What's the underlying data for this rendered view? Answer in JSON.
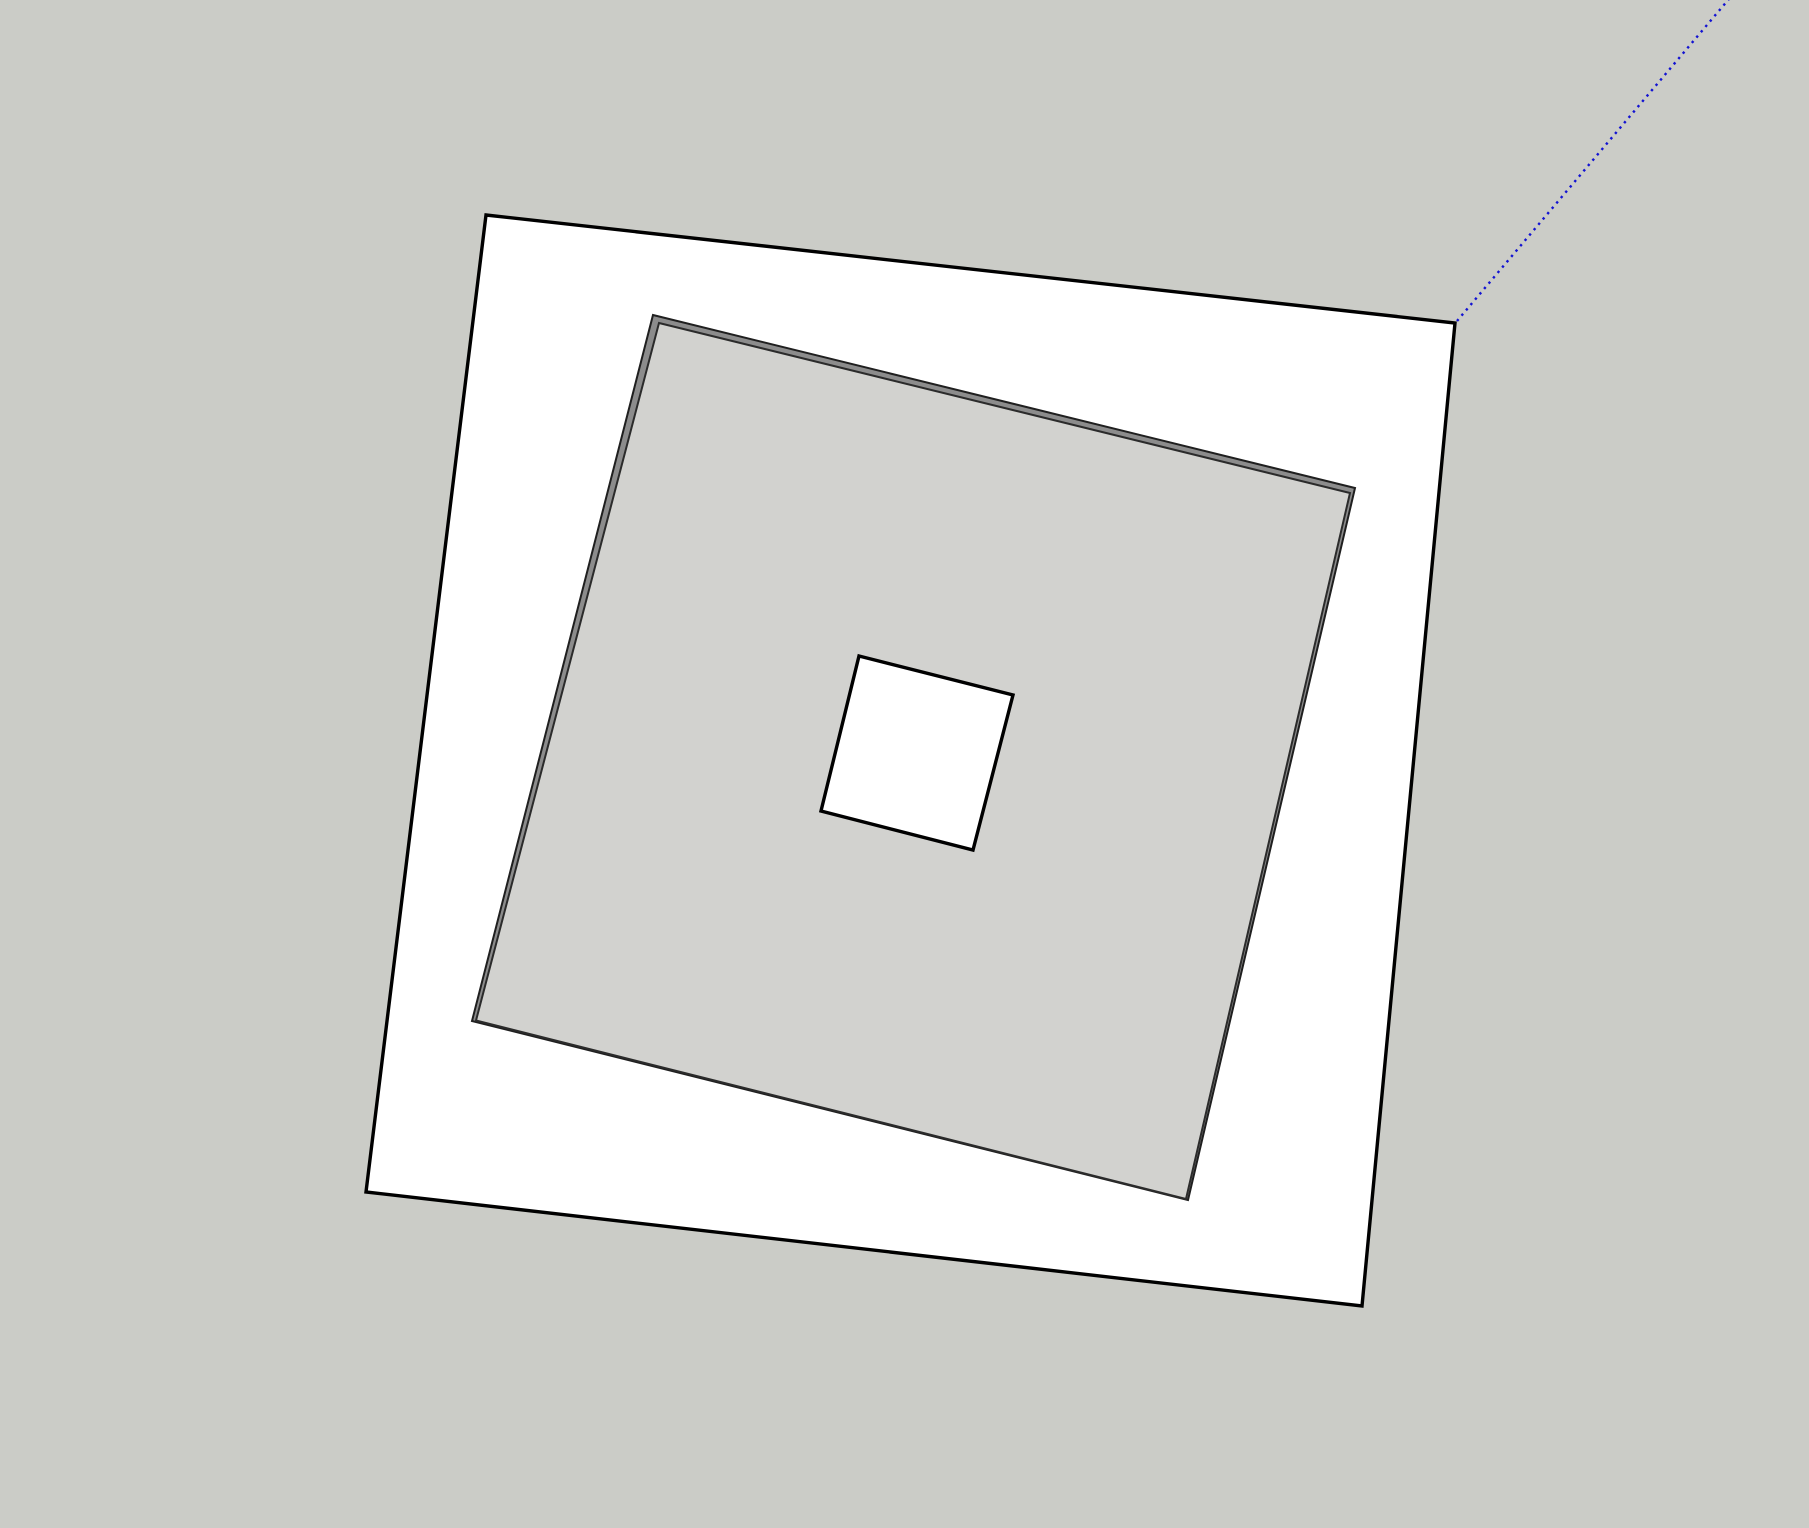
{
  "viewport": {
    "width": "1809",
    "height": "1528",
    "background_color": "#cbccc7",
    "colors": {
      "face_white": "#ffffff",
      "face_gray": "#d2d2cf",
      "recess_wall_gray": "#8c8c8c",
      "edge_black": "#000000",
      "edge_dark": "#2b2b2b",
      "axis_blue": "#1212d2"
    },
    "shapes": {
      "outer_square": {
        "points": "486,215 1455,323 1362,1306 366,1192",
        "fill": "#ffffff",
        "stroke": "#000000",
        "stroke_width": "3.4"
      },
      "recess_wall": {
        "points": "653,315 1355,488 1188,1200 472,1021",
        "fill": "#8c8c8c",
        "stroke": "#1f1f1f",
        "stroke_width": "2"
      },
      "recess_face": {
        "points": "659,323 1350,493 1186,1199 476,1020.5",
        "fill": "#d2d2cf",
        "stroke": "#2b2b2b",
        "stroke_width": "2"
      },
      "center_hole": {
        "points": "859,656 1013,695 973,850 821,811",
        "fill": "#ffffff",
        "stroke": "#000000",
        "stroke_width": "3.4"
      }
    },
    "axis_line": {
      "x1": "1457",
      "y1": "321",
      "x2": "1734",
      "y2": "-7",
      "stroke": "#1212d2",
      "stroke_width": "2.4",
      "dash": "2.4 4.6"
    }
  }
}
